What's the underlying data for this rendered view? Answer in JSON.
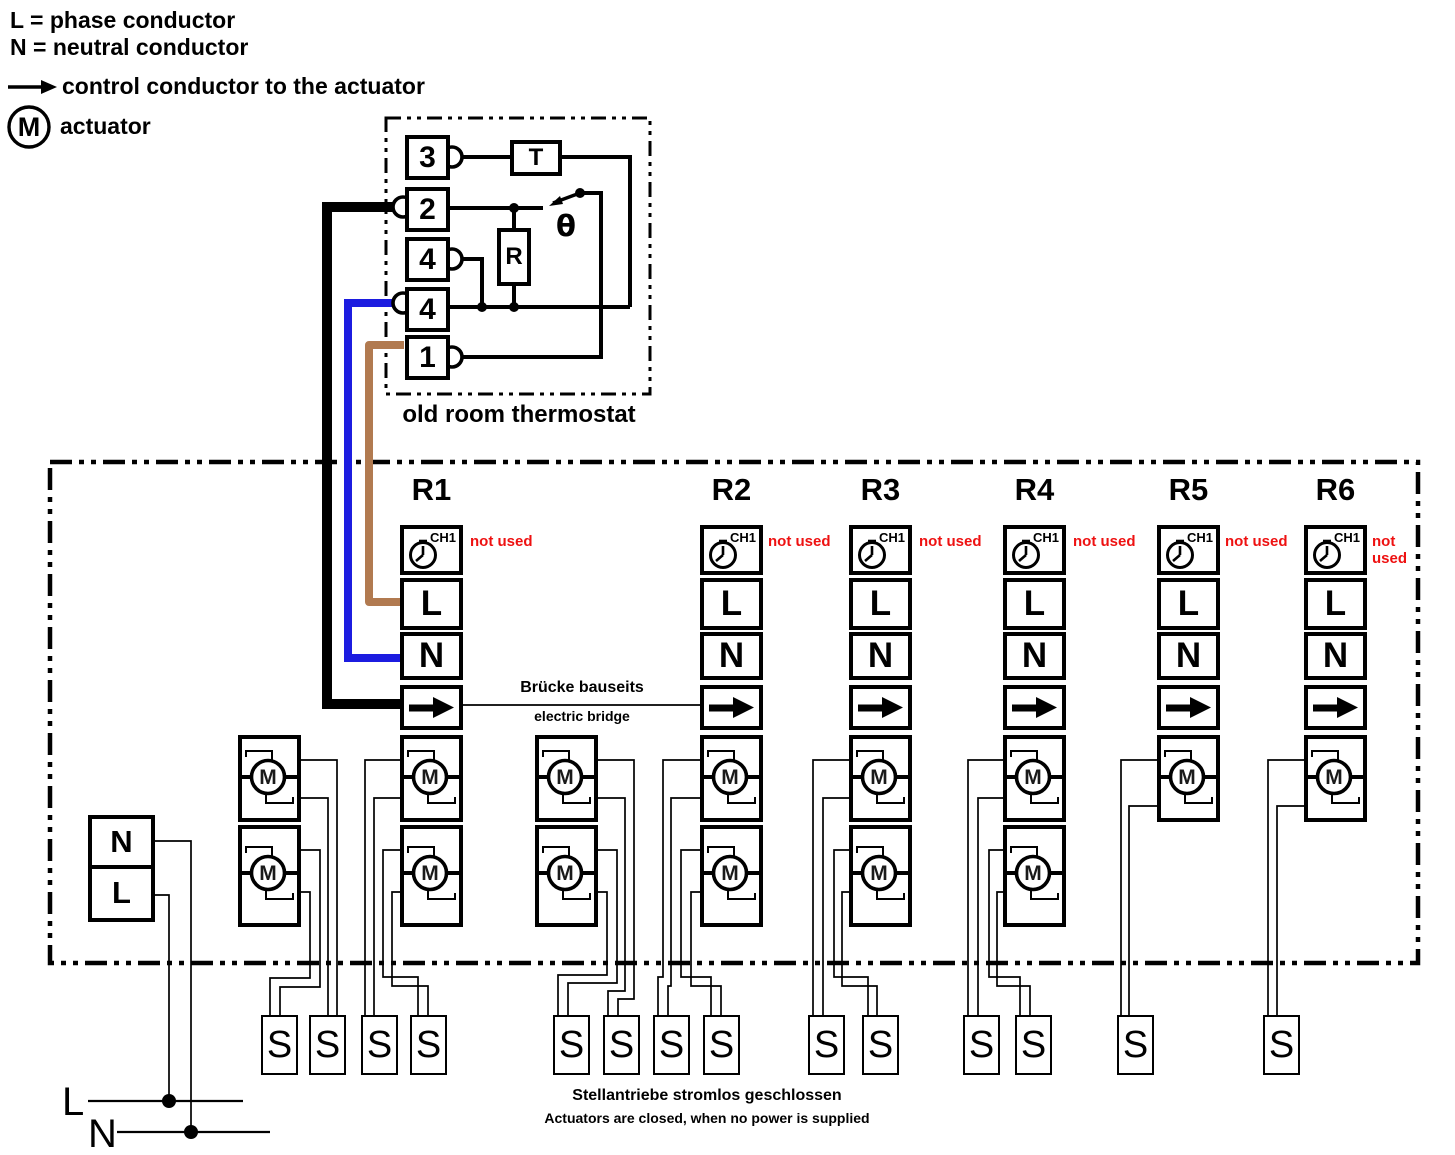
{
  "legend": {
    "line_l": "L = phase conductor",
    "line_n": "N = neutral conductor",
    "line_arrow": "control conductor to the actuator",
    "line_m": "actuator",
    "m_symbol": "M"
  },
  "thermostat": {
    "terminals": [
      "3",
      "2",
      "4",
      "4",
      "1"
    ],
    "t_label": "T",
    "r_label": "R",
    "theta": "θ",
    "caption": "old room thermostat"
  },
  "distributor": {
    "channels": [
      {
        "id": "R1",
        "ch_label": "CH1",
        "not_used": "not used",
        "l": "L",
        "n": "N",
        "m_count": 2
      },
      {
        "id": "R2",
        "ch_label": "CH1",
        "not_used": "not used",
        "l": "L",
        "n": "N",
        "m_count": 2
      },
      {
        "id": "R3",
        "ch_label": "CH1",
        "not_used": "not used",
        "l": "L",
        "n": "N",
        "m_count": 2
      },
      {
        "id": "R4",
        "ch_label": "CH1",
        "not_used": "not used",
        "l": "L",
        "n": "N",
        "m_count": 2
      },
      {
        "id": "R5",
        "ch_label": "CH1",
        "not_used": "not used",
        "l": "L",
        "n": "N",
        "m_count": 1
      },
      {
        "id": "R6",
        "ch_label": "CH1",
        "not_used": "not used",
        "l": "L",
        "n": "N",
        "m_count": 1
      }
    ],
    "bridge_de": "Brücke bauseits",
    "bridge_en": "electric bridge"
  },
  "mains_terminal": {
    "n": "N",
    "l": "L"
  },
  "supply": {
    "l": "L",
    "n": "N"
  },
  "plugs": {
    "label": "S"
  },
  "actuator": {
    "m": "M"
  },
  "note": {
    "de": "Stellantriebe stromlos geschlossen",
    "en": "Actuators are closed, when no power is supplied"
  },
  "colors": {
    "wire_black": "#000000",
    "wire_blue": "#1c1ce0",
    "wire_brown": "#b17a50",
    "not_used": "#ee1111"
  }
}
